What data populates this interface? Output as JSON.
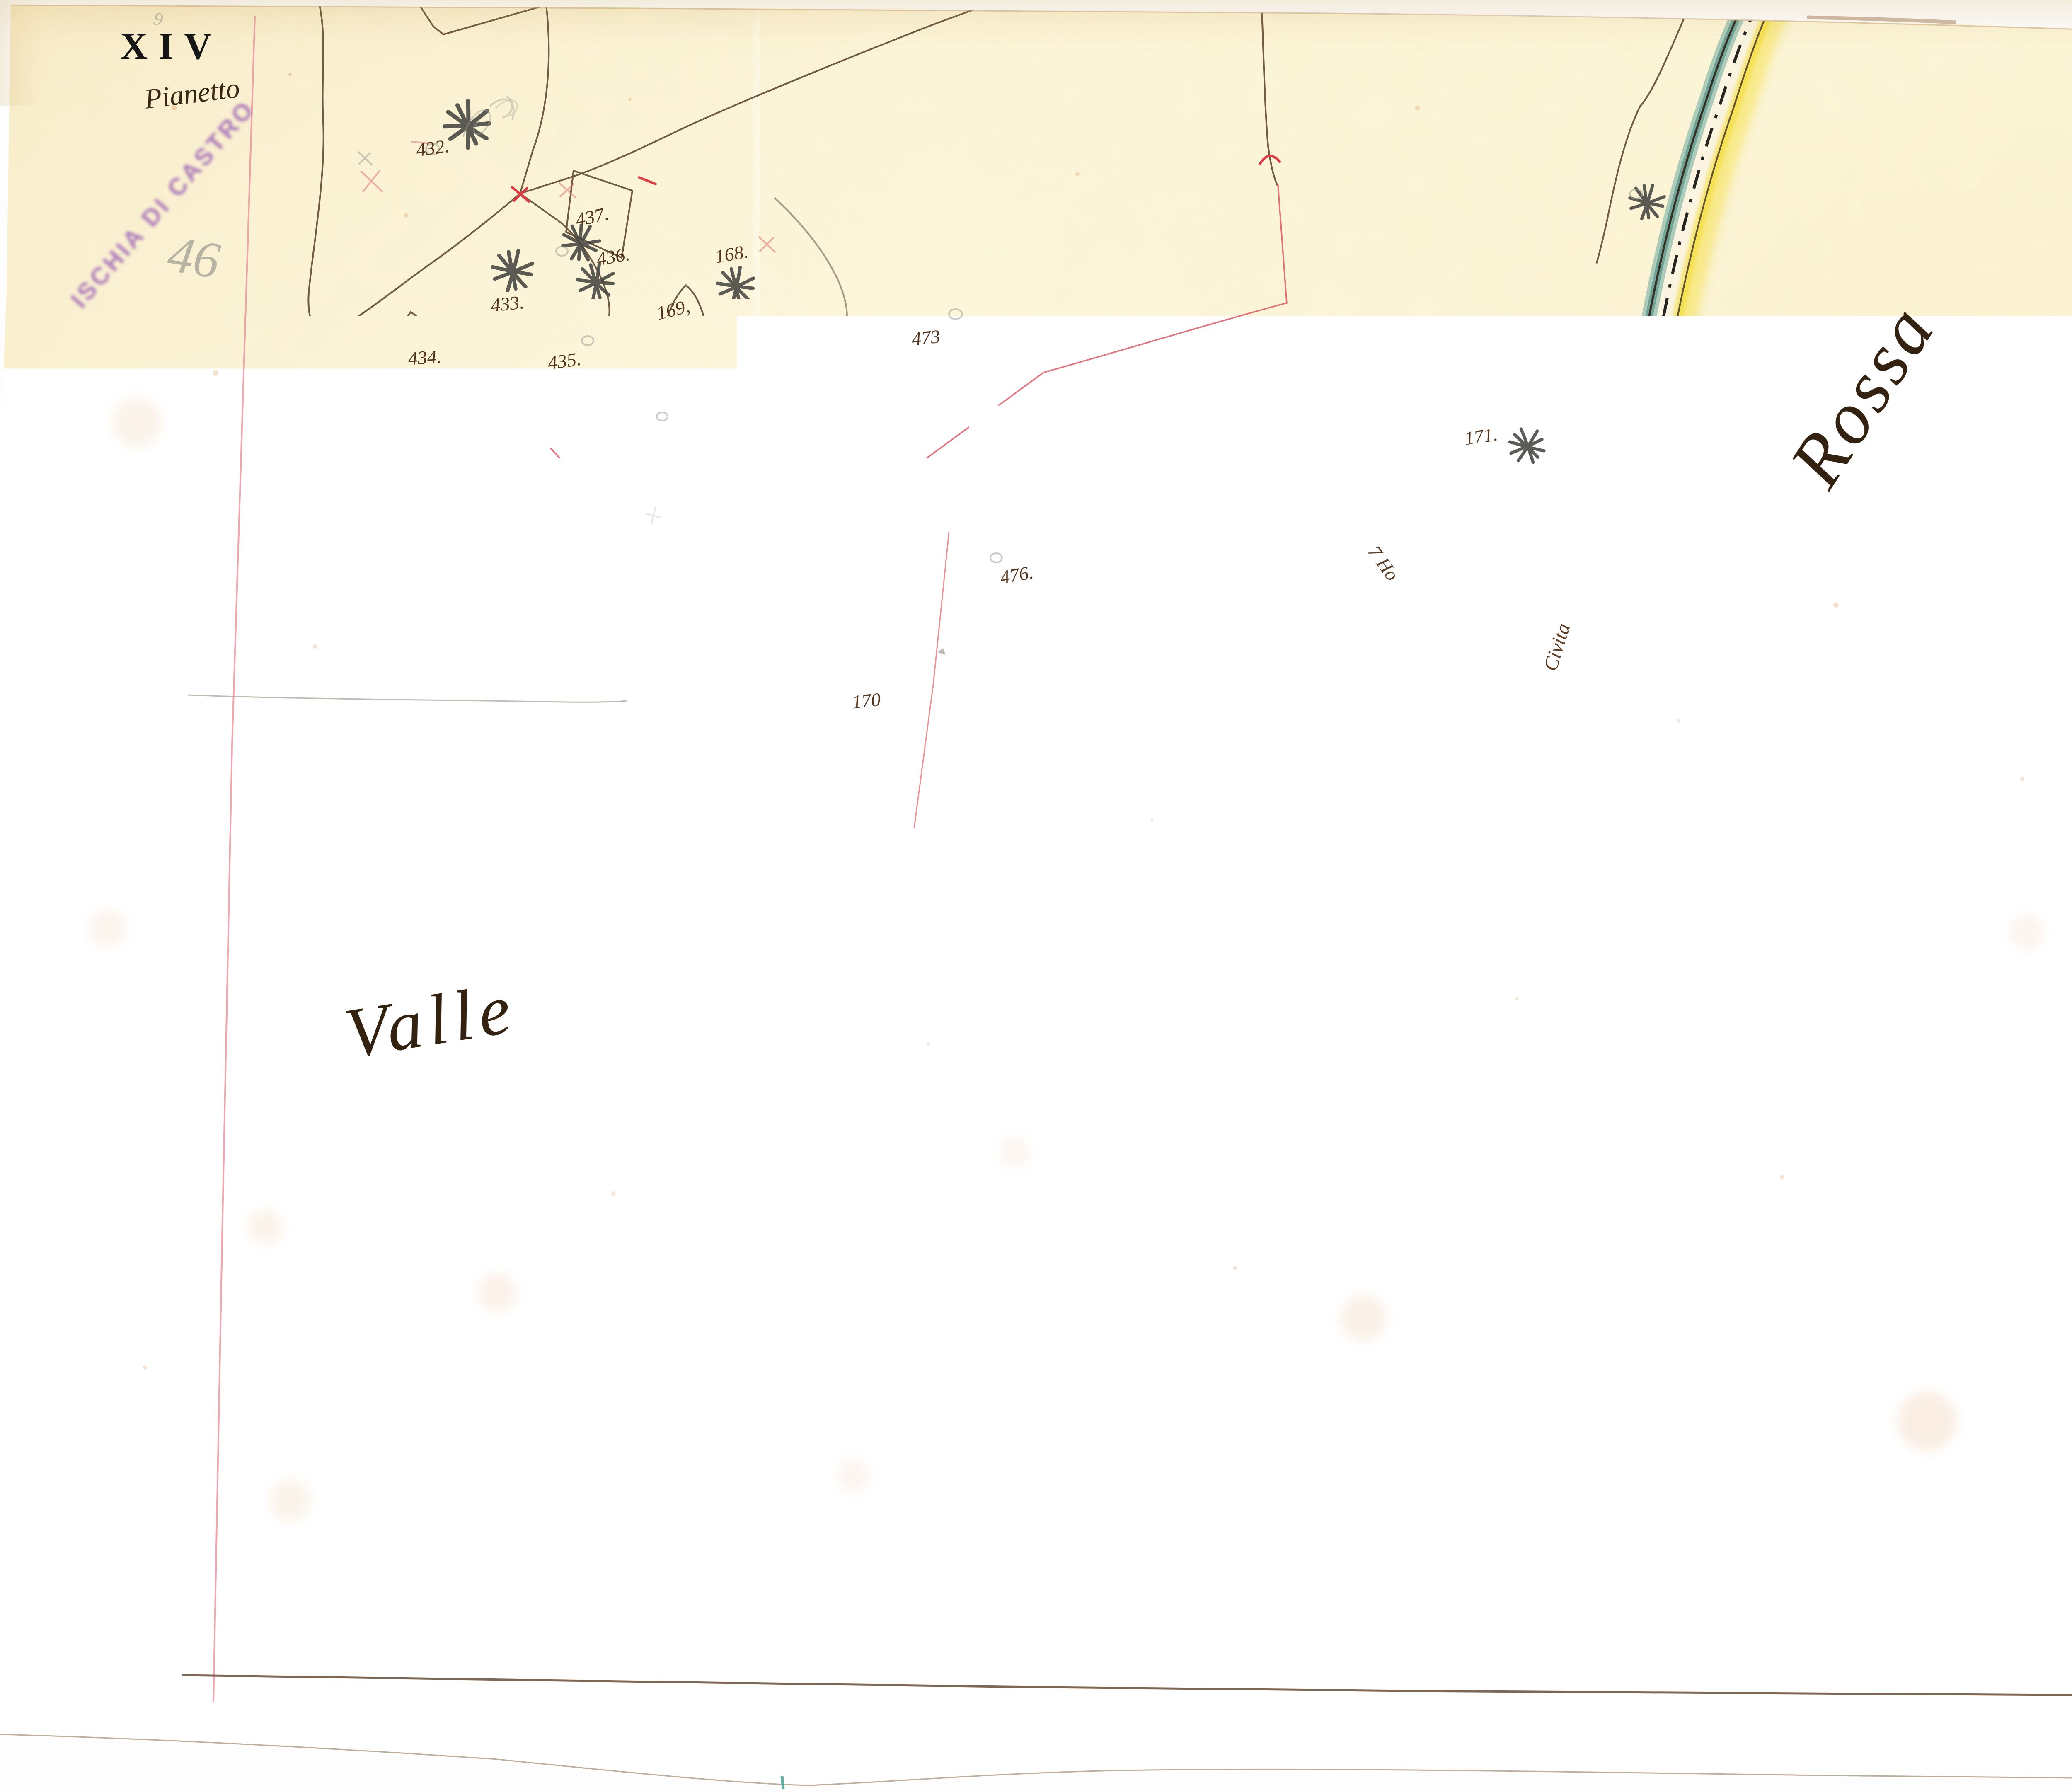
{
  "sheet": {
    "number": "XIV",
    "title": "Pianetto",
    "stamp": "ISCHIA DI CASTRO",
    "pencil_note_large": "46",
    "pencil_note_small": "9",
    "pencil_letter": "h",
    "blue_stamp_text": "17"
  },
  "toponyms": {
    "left": "Valle",
    "right": "Rossa"
  },
  "road_labels": {
    "left_branch": "7 Ho",
    "right_branch": "Civita"
  },
  "parcels": [
    {
      "label": "432."
    },
    {
      "label": "433."
    },
    {
      "label": "434."
    },
    {
      "label": "435."
    },
    {
      "label": "436."
    },
    {
      "label": "437."
    },
    {
      "label": "169,"
    },
    {
      "label": "168."
    },
    {
      "label": "473"
    },
    {
      "label": "476."
    },
    {
      "label": "170"
    },
    {
      "label": "171."
    },
    {
      "label": "172."
    }
  ],
  "colors": {
    "paper": "#fcf5d8",
    "ink_sepia": "#5d4730",
    "ink_label": "#53331c",
    "road_teal": "#6ba092",
    "road_yellow": "#f5df3d",
    "section_red": "#e0646e",
    "border_pink": "#e89098",
    "stamp_purple": "#9a5fb5",
    "stamp_blue": "#6779bd",
    "graphite": "#4a4a46"
  }
}
